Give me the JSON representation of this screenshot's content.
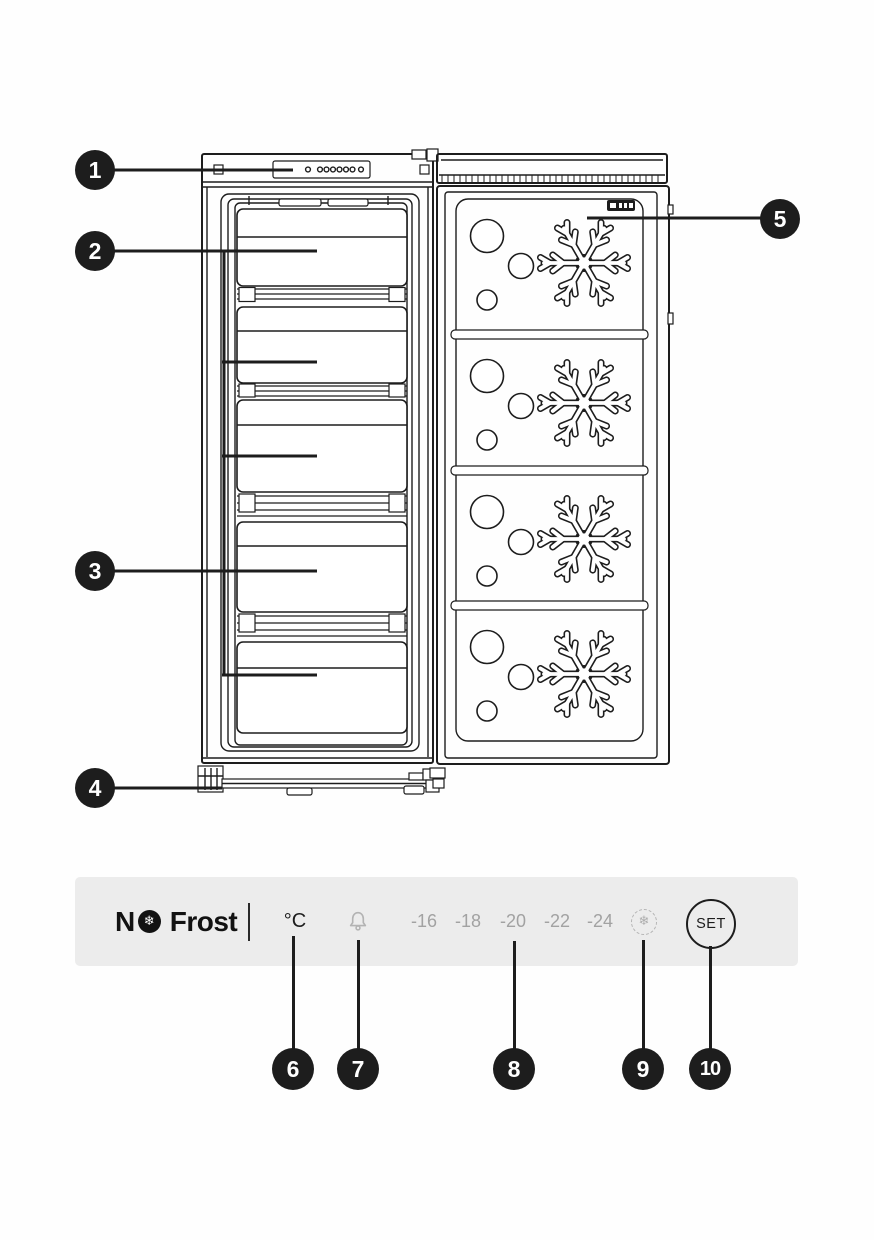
{
  "figure": {
    "callouts": {
      "c1": "1",
      "c2": "2",
      "c3": "3",
      "c4": "4",
      "c5": "5",
      "c6": "6",
      "c7": "7",
      "c8": "8",
      "c9": "9",
      "c10": "10"
    }
  },
  "control_panel": {
    "brand_prefix": "N",
    "brand_suffix": "Frost",
    "snowflake_glyph": "❄",
    "temp_unit": "°C",
    "temperatures": [
      "-16",
      "-18",
      "-20",
      "-22",
      "-24"
    ],
    "set_label": "SET",
    "colors": {
      "bar_bg": "#ececec",
      "ink": "#1d1d1d",
      "muted": "#a2a2a2",
      "icon_gray": "#b3b3b3"
    }
  }
}
